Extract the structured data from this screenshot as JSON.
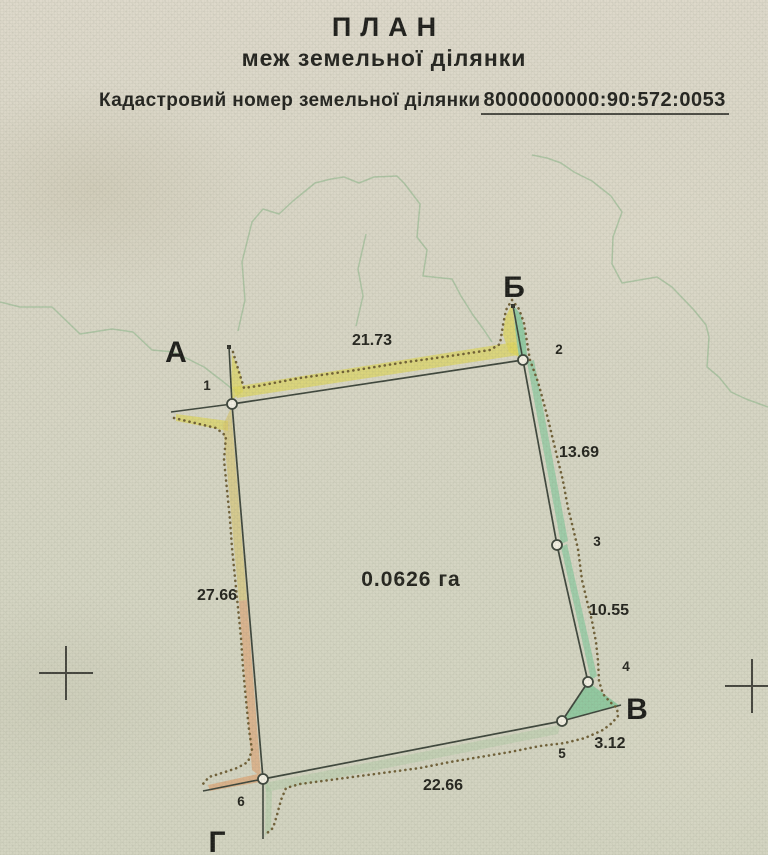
{
  "document": {
    "title": "ПЛАН",
    "subtitle": "меж земельної ділянки",
    "cadastral_label": "Кадастровий номер земельної ділянки",
    "cadastral_number": "8000000000:90:572:0053"
  },
  "plan": {
    "area_label": "0.0626 га",
    "area_label_x": 411,
    "area_label_y": 586,
    "points": [
      {
        "id": "1",
        "x": 232,
        "y": 404,
        "label_x": 207,
        "label_y": 390
      },
      {
        "id": "2",
        "x": 523,
        "y": 360,
        "label_x": 559,
        "label_y": 354
      },
      {
        "id": "3",
        "x": 557,
        "y": 545,
        "label_x": 597,
        "label_y": 546
      },
      {
        "id": "4",
        "x": 588,
        "y": 682,
        "label_x": 626,
        "label_y": 671
      },
      {
        "id": "5",
        "x": 562,
        "y": 721,
        "label_x": 562,
        "label_y": 758
      },
      {
        "id": "6",
        "x": 263,
        "y": 779,
        "label_x": 241,
        "label_y": 806
      }
    ],
    "corner_letters": [
      {
        "label": "А",
        "name": "a",
        "x": 176,
        "y": 362
      },
      {
        "label": "Б",
        "name": "b",
        "x": 514,
        "y": 297
      },
      {
        "label": "В",
        "name": "v",
        "x": 637,
        "y": 719
      },
      {
        "label": "Г",
        "name": "g",
        "x": 217,
        "y": 852
      }
    ],
    "edges": [
      {
        "from": "1",
        "to": "2",
        "length": "21.73",
        "label_x": 372,
        "label_y": 345
      },
      {
        "from": "2",
        "to": "3",
        "length": "13.69",
        "label_x": 579,
        "label_y": 457
      },
      {
        "from": "3",
        "to": "4",
        "length": "10.55",
        "label_x": 609,
        "label_y": 615
      },
      {
        "from": "4",
        "to": "5",
        "length": "3.12",
        "label_x": 610,
        "label_y": 748
      },
      {
        "from": "5",
        "to": "6",
        "length": "22.66",
        "label_x": 443,
        "label_y": 790
      },
      {
        "from": "6",
        "to": "1",
        "length": "27.66",
        "label_x": 217,
        "label_y": 600
      }
    ]
  },
  "artwork": {
    "contours": [
      {
        "d": "M 0,302 L 20,307 L 52,307 L 80,334 L 112,329 L 133,332 L 152,350 L 174,352 L 186,358 L 204,367 L 221,380 L 236,392"
      },
      {
        "d": "M 238,331 L 245,300 L 242,262 L 252,222 L 263,209 L 279,214 L 293,201 L 315,183 L 331,179 L 344,177 L 359,183 L 374,177 L 397,176 L 404,183 L 420,204 L 417,237 L 427,250 L 423,276 L 452,279 L 461,296 L 473,315 L 484,330 L 492,342"
      },
      {
        "d": "M 366,234 L 358,269 L 363,296 L 356,326"
      },
      {
        "d": "M 532,155 L 547,158 L 561,163 L 574,172 L 592,181 L 611,196 L 622,212 L 613,237 L 612,264 L 622,283 L 657,277 L 672,287 L 694,310 L 706,325 L 709,337 L 707,367 L 719,377 L 731,392 L 746,399 L 768,407"
      }
    ],
    "bands": [
      {
        "points": "237,398 519,355 515,342 233,387",
        "fill": "#ddd45e",
        "opacity": 0.7
      },
      {
        "points": "231,400 232,354 241,375 243,392",
        "fill": "#ddd45e",
        "opacity": 0.7
      },
      {
        "points": "176,414 228,421 228,431 176,421",
        "fill": "#ddd45e",
        "opacity": 0.7
      },
      {
        "points": "512,304 505,318 503,335 509,352 519,357 515,325",
        "fill": "#ddd45e",
        "opacity": 0.75
      },
      {
        "points": "514,306 521,315 525,333 527,355 519,358 515,328",
        "fill": "#7cc697",
        "opacity": 0.75
      },
      {
        "points": "527,362 561,544 568,541 534,360",
        "fill": "#7cc697",
        "opacity": 0.6
      },
      {
        "points": "561,547 591,680 597,676 567,544",
        "fill": "#7cc697",
        "opacity": 0.6
      },
      {
        "points": "588,682 562,721 620,706",
        "fill": "#6fc18e",
        "opacity": 0.65
      },
      {
        "points": "560,725 264,783 266,792 558,734",
        "fill": "#a9c9a1",
        "opacity": 0.4
      },
      {
        "points": "266,781 272,792 271,830 265,836",
        "fill": "#a9c9a1",
        "opacity": 0.5
      },
      {
        "points": "231,408 247,600 239,601 223,425",
        "fill": "#d6c36c",
        "opacity": 0.6
      },
      {
        "points": "247,600 261,777 252,770 239,601",
        "fill": "#dd9f6d",
        "opacity": 0.6
      },
      {
        "points": "208,785 258,774 260,782 210,791",
        "fill": "#dd9f6d",
        "opacity": 0.65
      }
    ],
    "dotted": [
      {
        "d": "M 233,352 L 239,372 L 244,388 L 258,386 L 300,378 L 350,371 L 400,363 L 450,356 L 490,350 L 500,344 L 503,325 L 506,310 L 512,300 L 519,309 L 524,323 L 527,342 L 530,360 L 538,382 L 547,415 L 555,448 L 563,481 L 568,508 L 573,528 L 578,549 L 582,580 L 587,601 L 592,621 L 596,642 L 598,661 L 599,681 L 603,694 L 610,702 L 617,708 L 618,716 L 612,723 L 603,730 L 585,738 L 565,743 L 540,746 L 510,752 L 480,757 L 450,762 L 420,768 L 390,772 L 360,776 L 330,780 L 300,784 L 286,788 L 281,800 L 277,815 L 273,828 L 266,834"
      },
      {
        "d": "M 174,418 L 195,423 L 216,428 L 226,436 L 224,460 L 227,490 L 230,520 L 232,548 L 235,578 L 238,608 L 241,638 L 243,668 L 246,700 L 249,730 L 252,750 L 248,762 L 237,768 L 222,773 L 209,777 L 203,784"
      }
    ],
    "whiskers": [
      {
        "x1": 232,
        "y1": 404,
        "x2": 229,
        "y2": 347
      },
      {
        "x1": 232,
        "y1": 404,
        "x2": 171,
        "y2": 412
      },
      {
        "x1": 523,
        "y1": 360,
        "x2": 513,
        "y2": 306
      },
      {
        "x1": 562,
        "y1": 721,
        "x2": 621,
        "y2": 705
      },
      {
        "x1": 263,
        "y1": 779,
        "x2": 203,
        "y2": 791
      },
      {
        "x1": 263,
        "y1": 779,
        "x2": 263,
        "y2": 839
      }
    ],
    "tips": [
      {
        "x": 229,
        "y": 347
      },
      {
        "x": 513,
        "y": 306
      }
    ],
    "crosses": [
      {
        "x": 66,
        "y": 673,
        "arm": 27
      },
      {
        "x": 752,
        "y": 686,
        "arm": 27
      }
    ]
  },
  "colors": {
    "paper": "#d9d6c6",
    "ink": "#24241e",
    "boundary": "#3e463c",
    "dotted": "#6a5a30",
    "contour": "#a3bf9b",
    "cross": "#46463f",
    "point_fill": "#f2efe2"
  }
}
